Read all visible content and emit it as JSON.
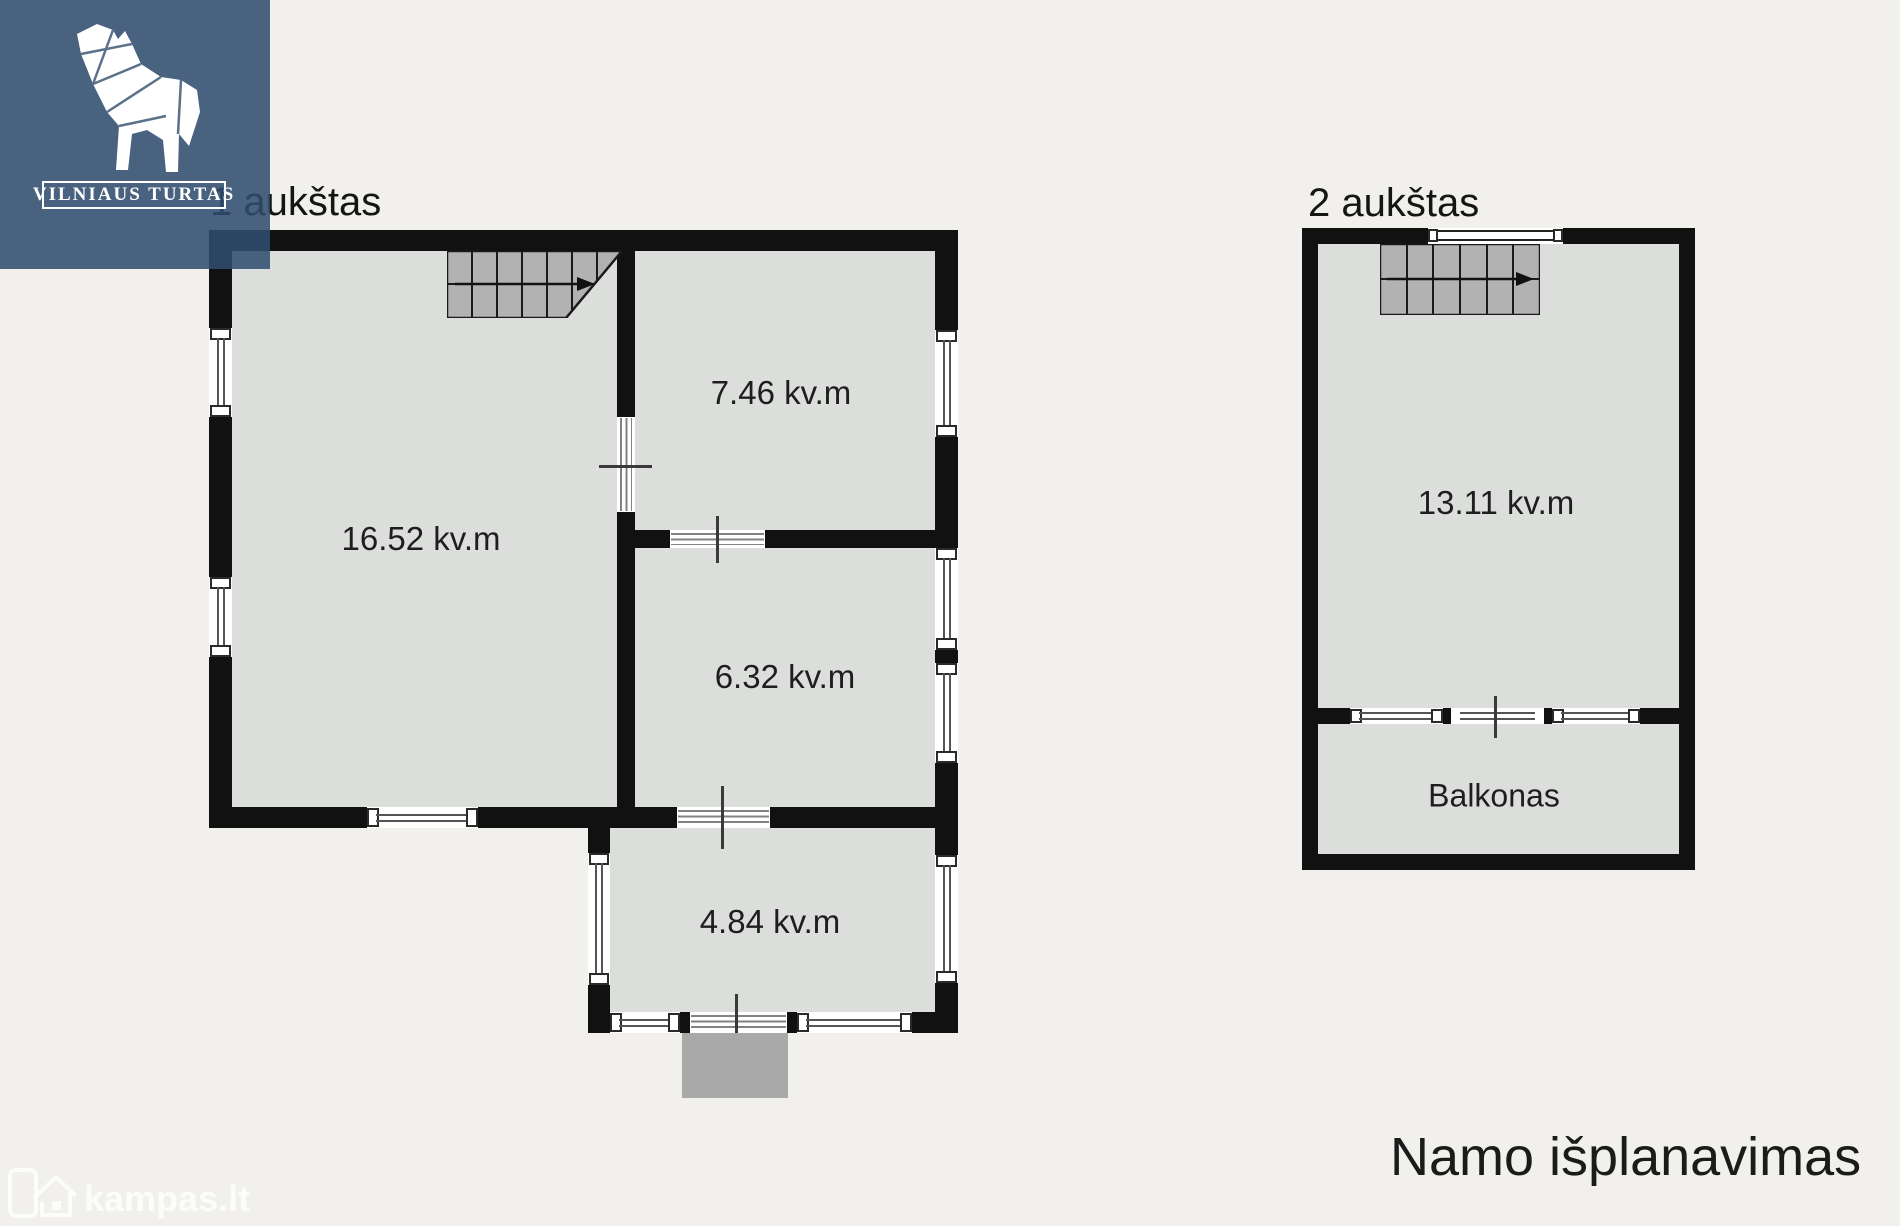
{
  "logo": {
    "brand": "VILNIAUS TURTAS",
    "icon": "wolf-icon",
    "bg_color": "#4a6480"
  },
  "floor1": {
    "title": "1 aukštas",
    "rooms": [
      {
        "area": "16.52 kv.m"
      },
      {
        "area": "7.46 kv.m"
      },
      {
        "area": "6.32 kv.m"
      },
      {
        "area": "4.84 kv.m"
      }
    ],
    "stairs_icon": "stairs-with-direction-arrow"
  },
  "floor2": {
    "title": "2 aukštas",
    "rooms": [
      {
        "area": "13.11 kv.m"
      }
    ],
    "balcony_label": "Balkonas",
    "stairs_icon": "stairs-with-direction-arrow"
  },
  "caption": {
    "title": "Namo išplanavimas"
  },
  "watermark": {
    "text": "kampas.lt",
    "icon": "kampas-house-logo-icon"
  },
  "colors": {
    "page_bg": "#f1f0ec",
    "wall": "#111111",
    "room_fill": "#dcdedc",
    "stairs_fill": "#b2b2b2",
    "entry_step": "#a9a9a9",
    "logo_blue": "#4a6480",
    "text": "#1e1e1e"
  }
}
